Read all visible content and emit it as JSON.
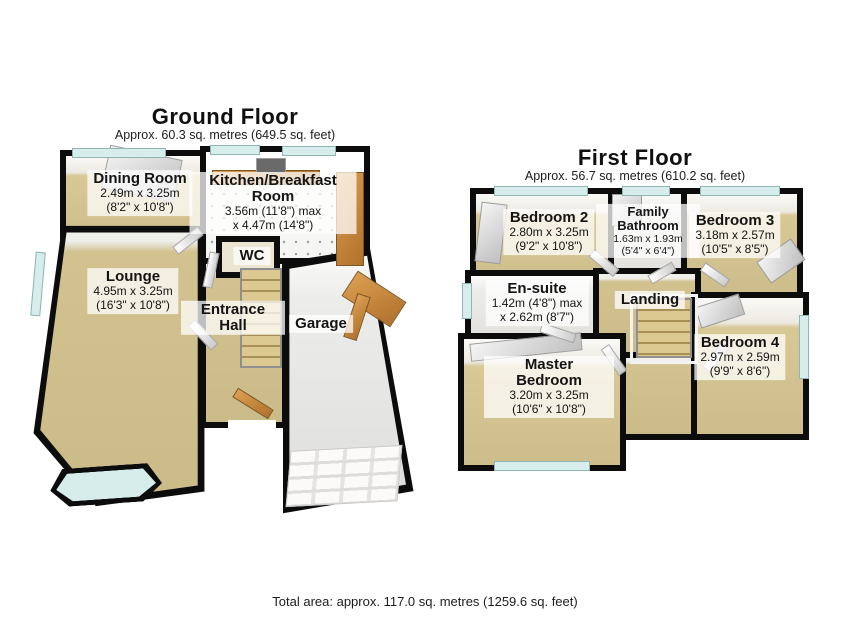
{
  "floors": {
    "ground": {
      "title": "Ground Floor",
      "subtitle": "Approx. 60.3 sq. metres (649.5 sq. feet)",
      "rooms": {
        "dining_room": {
          "name": "Dining Room",
          "dims1": "2.49m x 3.25m",
          "dims2": "(8'2\" x 10'8\")"
        },
        "kitchen": {
          "name": "Kitchen/Breakfast Room",
          "dims1": "3.56m (11'8\") max",
          "dims2": "x 4.47m (14'8\")"
        },
        "lounge": {
          "name": "Lounge",
          "dims1": "4.95m x 3.25m",
          "dims2": "(16'3\" x 10'8\")"
        },
        "wc": {
          "name": "WC"
        },
        "entrance_hall": {
          "name": "Entrance Hall"
        },
        "garage": {
          "name": "Garage"
        }
      }
    },
    "first": {
      "title": "First Floor",
      "subtitle": "Approx. 56.7 sq. metres (610.2 sq. feet)",
      "rooms": {
        "bedroom_2": {
          "name": "Bedroom 2",
          "dims1": "2.80m x 3.25m",
          "dims2": "(9'2\" x 10'8\")"
        },
        "family_bathroom": {
          "name": "Family Bathroom",
          "dims1": "1.63m x 1.93m",
          "dims2": "(5'4\" x 6'4\")"
        },
        "bedroom_3": {
          "name": "Bedroom 3",
          "dims1": "3.18m x 2.57m",
          "dims2": "(10'5\" x 8'5\")"
        },
        "en_suite": {
          "name": "En-suite",
          "dims1": "1.42m (4'8\") max",
          "dims2": "x 2.62m (8'7\")"
        },
        "landing": {
          "name": "Landing"
        },
        "master_bedroom": {
          "name": "Master Bedroom",
          "dims1": "3.20m x 3.25m",
          "dims2": "(10'6\" x 10'8\")"
        },
        "bedroom_4": {
          "name": "Bedroom 4",
          "dims1": "2.97m x 2.59m",
          "dims2": "(9'9\" x 8'6\")"
        }
      }
    }
  },
  "footer": {
    "total_area": "Total area: approx. 117.0 sq. metres (1259.6 sq. feet)"
  },
  "colors": {
    "wall": "#0c0c0c",
    "floor_tan": "#cfbf8d",
    "floor_light": "#e0e0de",
    "window_glass": "#d6edec",
    "wood": "#c98c42",
    "label_background": "rgba(255,255,255,0.74)"
  }
}
